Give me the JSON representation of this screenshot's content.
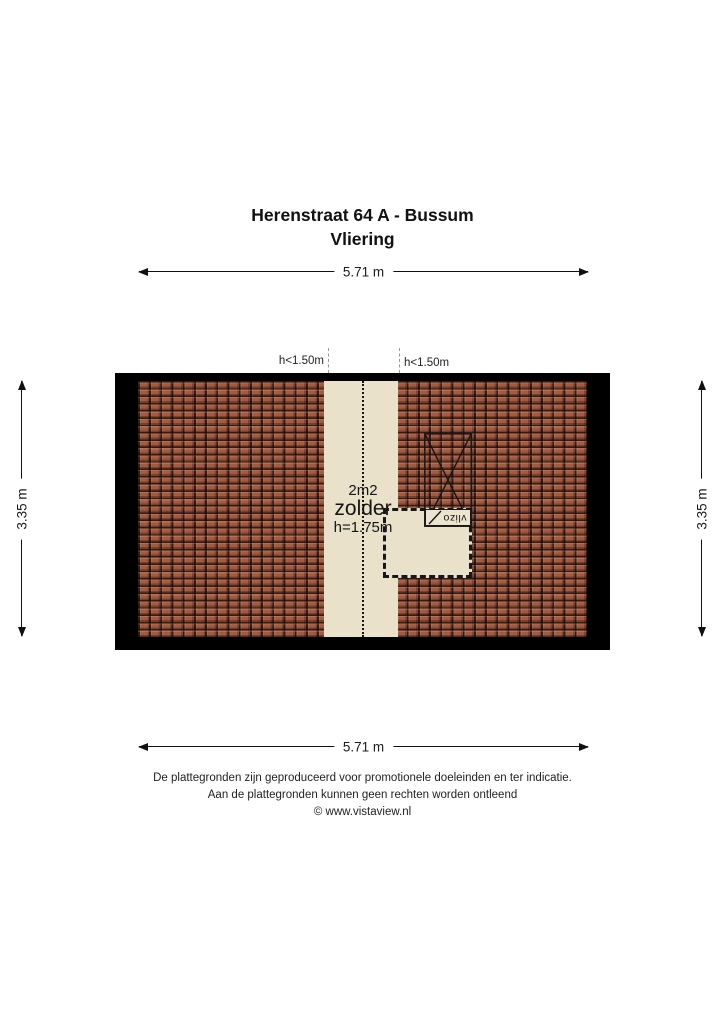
{
  "title": {
    "address": "Herenstraat 64 A - Bussum",
    "floor": "Vliering"
  },
  "dimensions": {
    "top": "5.71 m",
    "bottom": "5.71 m",
    "left": "3.35 m",
    "right": "3.35 m"
  },
  "floorplan": {
    "area_label": "2m2",
    "room_label": "zolder",
    "height_label": "h=1.75m",
    "low_headroom_left": "h<1.50m",
    "low_headroom_right": "h<1.50m",
    "hatch_label": "vlizo",
    "colors": {
      "wall": "#000000",
      "roof_tiles": "#a25a41",
      "tile_lines": "#2e150b",
      "floor": "#e9e1ca",
      "outline": "#171717"
    }
  },
  "footer": {
    "line1": "De plattegronden zijn geproduceerd voor promotionele doeleinden en ter indicatie.",
    "line2": "Aan de plattegronden kunnen geen rechten worden ontleend",
    "line3": "© www.vistaview.nl"
  }
}
